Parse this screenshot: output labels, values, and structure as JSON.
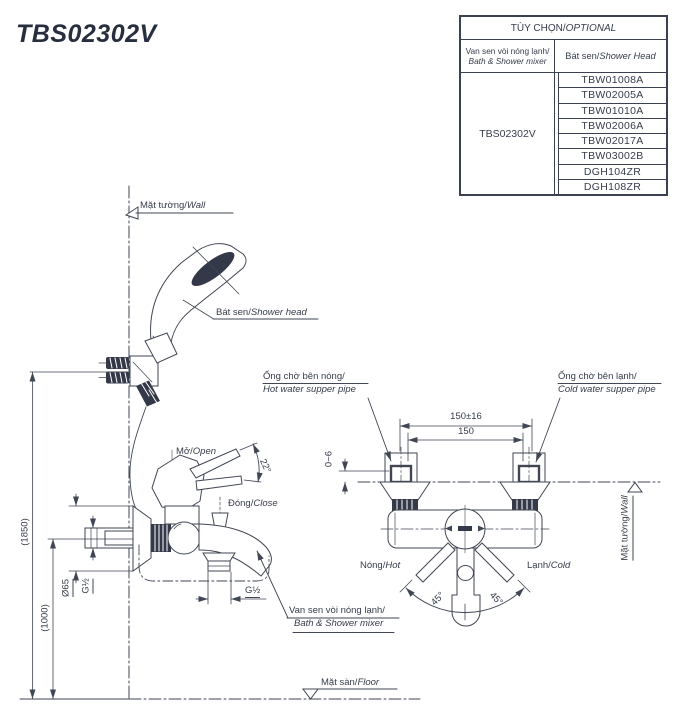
{
  "title": "TBS02302V",
  "colors": {
    "ink": "#404654",
    "dark_fill": "#333948",
    "title_color": "#272e3e"
  },
  "table": {
    "header": {
      "vi": "TÙY CHỌN/",
      "en": "OPTIONAL"
    },
    "col1": {
      "vi": "Van sen vòi nóng lạnh/",
      "en": "Bath & Shower mixer"
    },
    "col2": {
      "vi": "Bát sen/",
      "en": "Shower Head"
    },
    "mixer_model": "TBS02302V",
    "shower_heads": [
      "TBW01008A",
      "TBW02005A",
      "TBW01010A",
      "TBW02006A",
      "TBW02017A",
      "TBW03002B",
      "DGH104ZR",
      "DGH108ZR"
    ]
  },
  "labels": {
    "wall_left": {
      "vi": "Mặt tường/",
      "en": "Wall"
    },
    "shower_head": {
      "vi": "Bát sen/",
      "en": "Shower head"
    },
    "open": {
      "vi": "Mở/",
      "en": "Open"
    },
    "close": {
      "vi": "Đóng/",
      "en": "Close"
    },
    "hot_pipe": {
      "vi": "Ống chờ bên nóng/",
      "en": "Hot water supper pipe"
    },
    "cold_pipe": {
      "vi": "Ống chờ bên lạnh/",
      "en": "Cold water supper pipe"
    },
    "hot": {
      "vi": "Nóng/",
      "en": "Hot"
    },
    "cold": {
      "vi": "Lạnh/",
      "en": "Cold"
    },
    "mixer": {
      "vi": "Van sen vòi nóng lạnh/",
      "en": "Bath & Shower mixer"
    },
    "floor": {
      "vi": "Mặt sàn/",
      "en": "Floor"
    },
    "wall_right": {
      "vi": "Mặt tường/",
      "en": "Wall"
    }
  },
  "dimensions": {
    "height_shower": "(1850)",
    "height_mixer": "(1000)",
    "flange_diameter": "Ø65",
    "inlet_thread": "G½",
    "spout_thread": "G½",
    "pipe_pitch_tolerance": "150±16",
    "pipe_pitch": "150",
    "wall_protrusion": "0~6",
    "open_angle": "22°",
    "handle_angle_left": "45°",
    "handle_angle_right": "45°"
  }
}
